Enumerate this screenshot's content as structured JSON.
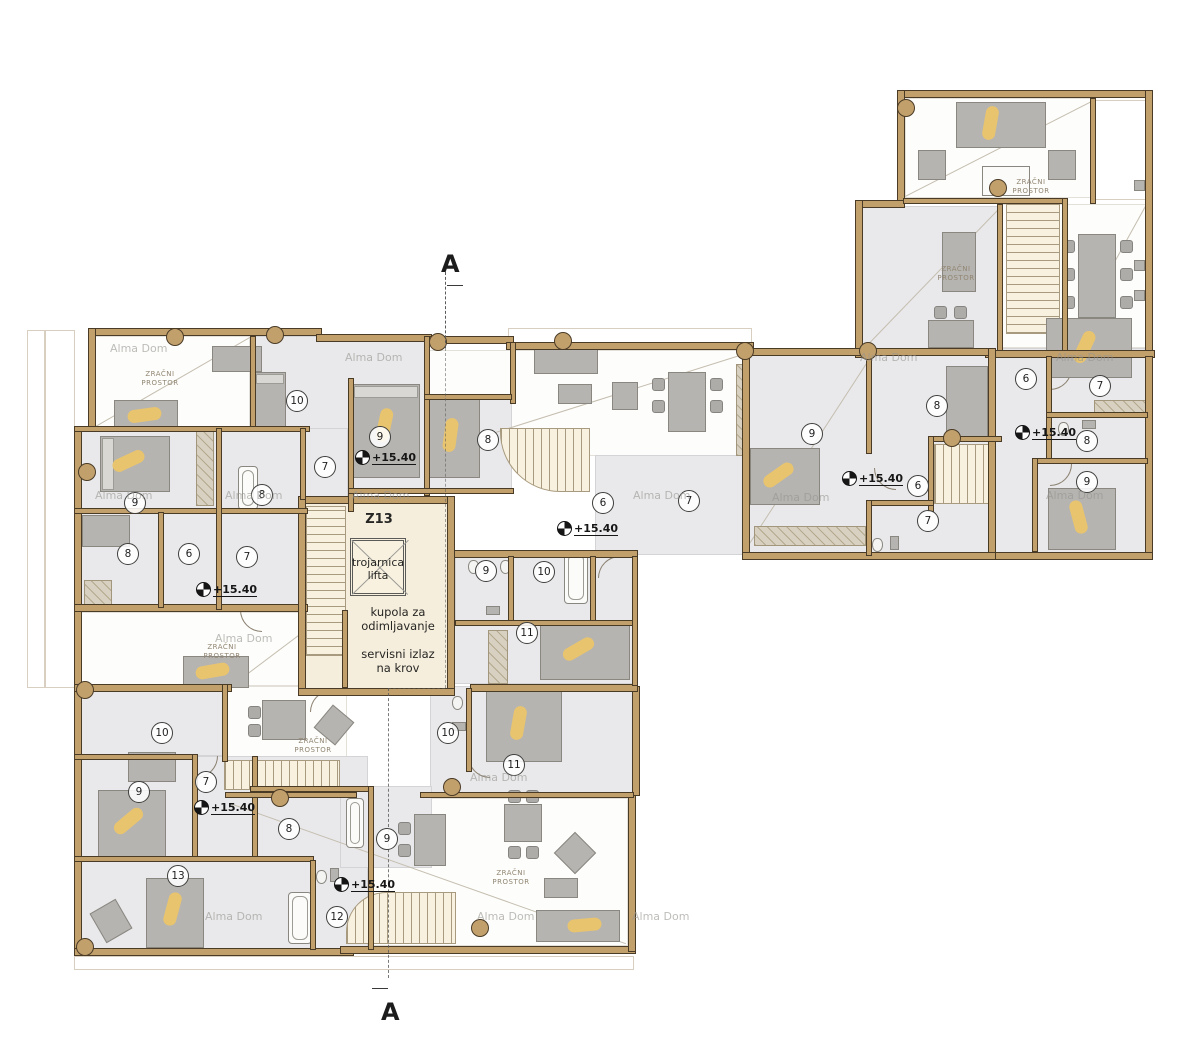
{
  "plan": {
    "core": {
      "code": "Z13",
      "elevator_label": "trojarnica\nlifta",
      "dome_label": "kupola za\nodimljavanje",
      "service_label": "servisni izlaz\nna krov"
    },
    "section_label": "A",
    "elevation_label": "+15.40",
    "air_space_label": "ZRAČNI\nPROSTOR",
    "watermark_label": "Alma Dom",
    "colors": {
      "wall": "#c2a06c",
      "room_gray": "#e9e9eb",
      "core_cream": "#f6eedc",
      "figure_gold": "#e8c46f",
      "furniture_gray": "#b6b4b0"
    },
    "room_numbers": [
      {
        "n": "10",
        "x": 297,
        "y": 401
      },
      {
        "n": "9",
        "x": 380,
        "y": 437
      },
      {
        "n": "7",
        "x": 325,
        "y": 467
      },
      {
        "n": "8",
        "x": 262,
        "y": 495
      },
      {
        "n": "9",
        "x": 135,
        "y": 503
      },
      {
        "n": "8",
        "x": 128,
        "y": 554
      },
      {
        "n": "6",
        "x": 189,
        "y": 554
      },
      {
        "n": "7",
        "x": 247,
        "y": 557
      },
      {
        "n": "8",
        "x": 488,
        "y": 440
      },
      {
        "n": "6",
        "x": 603,
        "y": 503
      },
      {
        "n": "7",
        "x": 689,
        "y": 501
      },
      {
        "n": "9",
        "x": 486,
        "y": 571
      },
      {
        "n": "10",
        "x": 544,
        "y": 572
      },
      {
        "n": "11",
        "x": 527,
        "y": 633
      },
      {
        "n": "10",
        "x": 448,
        "y": 733
      },
      {
        "n": "11",
        "x": 514,
        "y": 765
      },
      {
        "n": "9",
        "x": 812,
        "y": 434
      },
      {
        "n": "8",
        "x": 937,
        "y": 406
      },
      {
        "n": "6",
        "x": 918,
        "y": 486
      },
      {
        "n": "7",
        "x": 928,
        "y": 521
      },
      {
        "n": "6",
        "x": 1026,
        "y": 379
      },
      {
        "n": "7",
        "x": 1100,
        "y": 386
      },
      {
        "n": "8",
        "x": 1087,
        "y": 441
      },
      {
        "n": "9",
        "x": 1087,
        "y": 482
      },
      {
        "n": "10",
        "x": 162,
        "y": 733
      },
      {
        "n": "7",
        "x": 206,
        "y": 782
      },
      {
        "n": "9",
        "x": 139,
        "y": 792
      },
      {
        "n": "8",
        "x": 289,
        "y": 829
      },
      {
        "n": "13",
        "x": 178,
        "y": 876
      },
      {
        "n": "9",
        "x": 387,
        "y": 839
      },
      {
        "n": "12",
        "x": 337,
        "y": 917
      }
    ],
    "elevation_markers": [
      {
        "x": 362,
        "y": 457
      },
      {
        "x": 203,
        "y": 589
      },
      {
        "x": 564,
        "y": 528
      },
      {
        "x": 849,
        "y": 478
      },
      {
        "x": 1022,
        "y": 432
      },
      {
        "x": 201,
        "y": 807
      },
      {
        "x": 341,
        "y": 884
      }
    ],
    "air_spaces": [
      {
        "x": 160,
        "y": 370
      },
      {
        "x": 1031,
        "y": 178
      },
      {
        "x": 956,
        "y": 265
      },
      {
        "x": 222,
        "y": 643
      },
      {
        "x": 313,
        "y": 737
      },
      {
        "x": 511,
        "y": 869
      }
    ],
    "watermarks": [
      {
        "x": 110,
        "y": 342
      },
      {
        "x": 345,
        "y": 351
      },
      {
        "x": 860,
        "y": 351
      },
      {
        "x": 1056,
        "y": 351
      },
      {
        "x": 95,
        "y": 489
      },
      {
        "x": 225,
        "y": 489
      },
      {
        "x": 352,
        "y": 489
      },
      {
        "x": 633,
        "y": 489
      },
      {
        "x": 772,
        "y": 491
      },
      {
        "x": 1046,
        "y": 489
      },
      {
        "x": 215,
        "y": 632
      },
      {
        "x": 470,
        "y": 771
      },
      {
        "x": 205,
        "y": 910
      },
      {
        "x": 477,
        "y": 910
      },
      {
        "x": 632,
        "y": 910
      }
    ]
  }
}
